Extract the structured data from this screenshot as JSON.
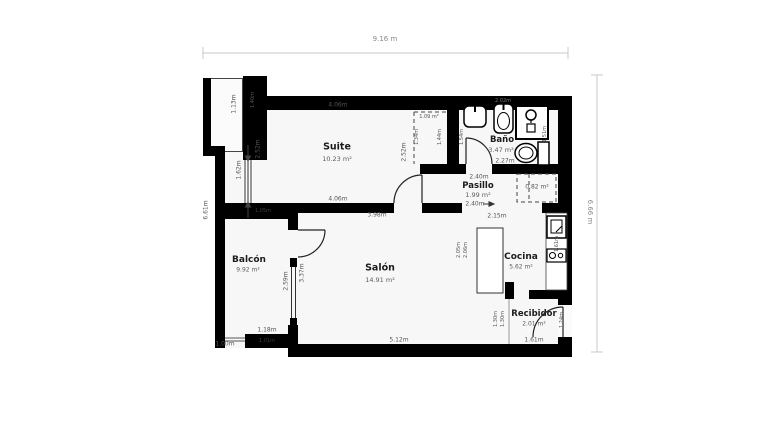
{
  "overall": {
    "width_label": "9.16 m",
    "height_label_right": "6.66 m",
    "height_label_left": "6.61m"
  },
  "suite": {
    "name": "Suite",
    "area": "10.23 m²",
    "dim_top": "4.06m",
    "dim_bottom": "4.06m",
    "dim_left": "2.52m",
    "dim_right": "2.52m",
    "window_dim": "1.62m"
  },
  "suite_closet": {
    "area": "1.09 m²",
    "dim_a": "1.34m",
    "dim_b": "1.44m",
    "dim_c": "1.54m"
  },
  "bano": {
    "name": "Baño",
    "area": "3.47 m²",
    "dim_bottom": "2.27m",
    "fixture_dim": "2.02m",
    "dim_right": "1.51m"
  },
  "pasillo": {
    "name": "Pasillo",
    "area": "1.99 m²",
    "dim_top": "2.40m",
    "dim_bottom": "2.40m",
    "dim_under": "2.15m"
  },
  "pasillo_closet": {
    "area": "0.82 m²"
  },
  "cocina": {
    "name": "Cocina",
    "area": "5.62 m²",
    "island_dim_a": "2.05m",
    "island_dim_b": "2.06m",
    "counter_dim": "1.61m"
  },
  "salon": {
    "name": "Salón",
    "area": "14.91 m²",
    "dim_top": "3.98m",
    "dim_bottom": "5.12m",
    "dim_left": "3.37m"
  },
  "balcon": {
    "name": "Balcón",
    "area": "9.92 m²",
    "dim_bottom": "1.18m",
    "dim_bottom_left": "1.00m",
    "dim_right": "2.59m",
    "wall_label_top": "1.05m",
    "wall_label_bottom": "1.01m",
    "notch_dim": "1.13m",
    "column_dim": "1.40m"
  },
  "recibidor": {
    "name": "Recibidor",
    "area": "2.01 m²",
    "dim_bottom": "1.61m",
    "dim_left_a": "1.30m",
    "dim_left_b": "1.30m",
    "dim_right": "1.24m"
  },
  "colors": {
    "wall": "#000000",
    "floor": "#f7f7f7",
    "dim_text": "#555555"
  }
}
